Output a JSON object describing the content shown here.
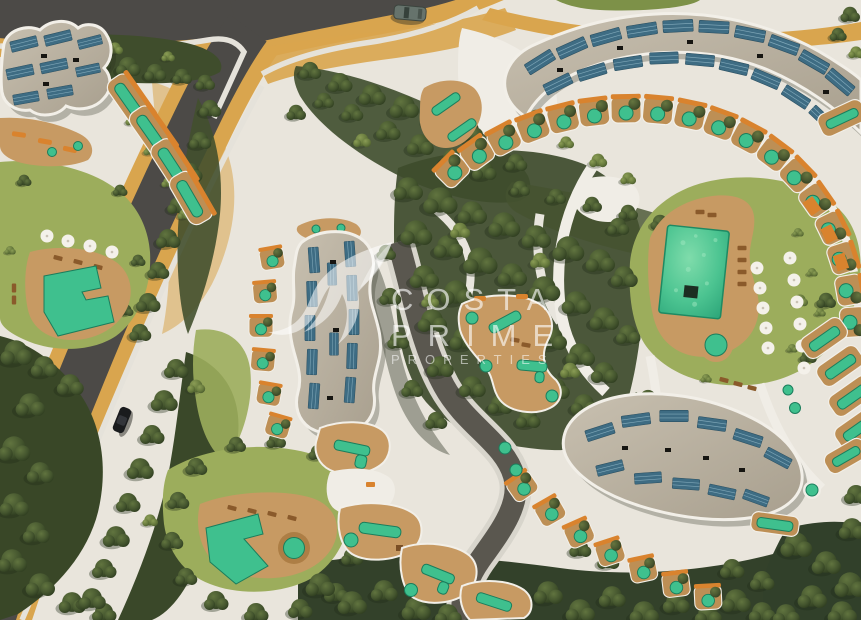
{
  "watermark": {
    "line1": "COSTA",
    "line2": "PRIME",
    "line3": "PROPERTIES",
    "logo_icon": "swallow-bird-icon",
    "color": "#ffffff"
  },
  "palette": {
    "ground": "#e9e5dc",
    "asphalt": "#4c4a47",
    "road_shoulder_sand": "#d9a54e",
    "sidewalk": "#e5e2da",
    "inner_path_gray": "#5a574f",
    "lawn": "#9cad5c",
    "forest_green": "#3d4b2b",
    "deck_tan": "#c79a63",
    "terrace_tan": "#bd8f55",
    "roof_gravel": "#beb5a6",
    "solar_panel_blue": "#3e6c83",
    "pool_green": "#3fc08e",
    "pool_edge_green": "#1b7d5c",
    "accent_orange": "#d9832e",
    "car_top_color": "#66736c",
    "car_road_color": "#1a1b1d"
  }
}
